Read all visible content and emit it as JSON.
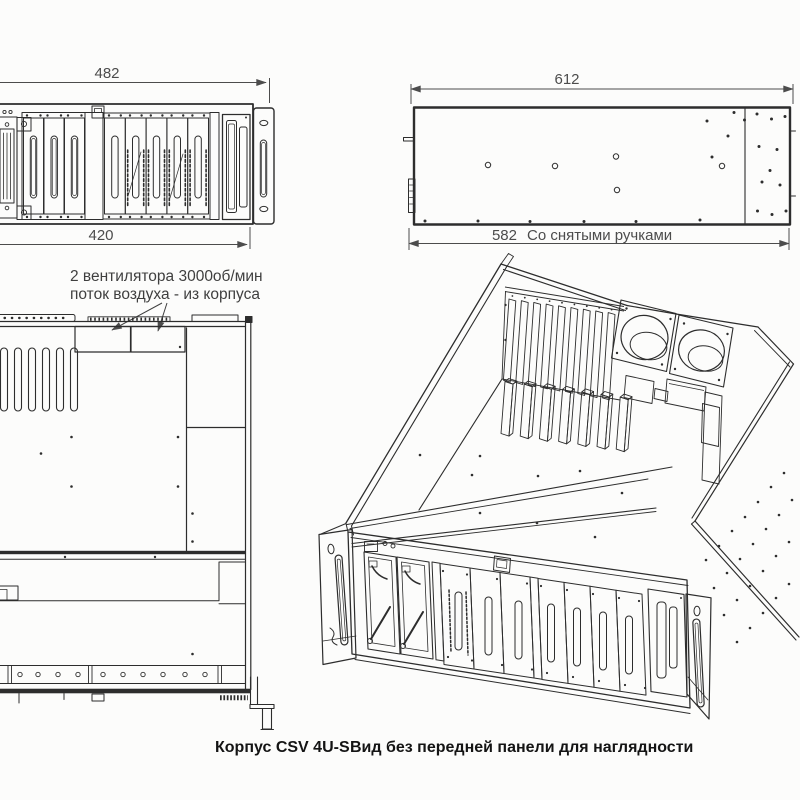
{
  "colors": {
    "background": "#fcfcfb",
    "line": "#2d2d2d",
    "dimension": "#4c4c4c",
    "caption_text": "#141414"
  },
  "front_view": {
    "dim_overall_width": "482",
    "dim_body_width": "420"
  },
  "side_view": {
    "dim_overall_length": "612",
    "dim_no_handles_value": "582",
    "dim_no_handles_note": "Со снятыми ручками"
  },
  "section_view": {
    "fan_note_line1": "2 вентилятора 3000об/мин",
    "fan_note_line2": "поток воздуха - из корпуса"
  },
  "caption": {
    "model": "Корпус CSV 4U-S",
    "note": "Вид без передней панели для наглядности"
  }
}
